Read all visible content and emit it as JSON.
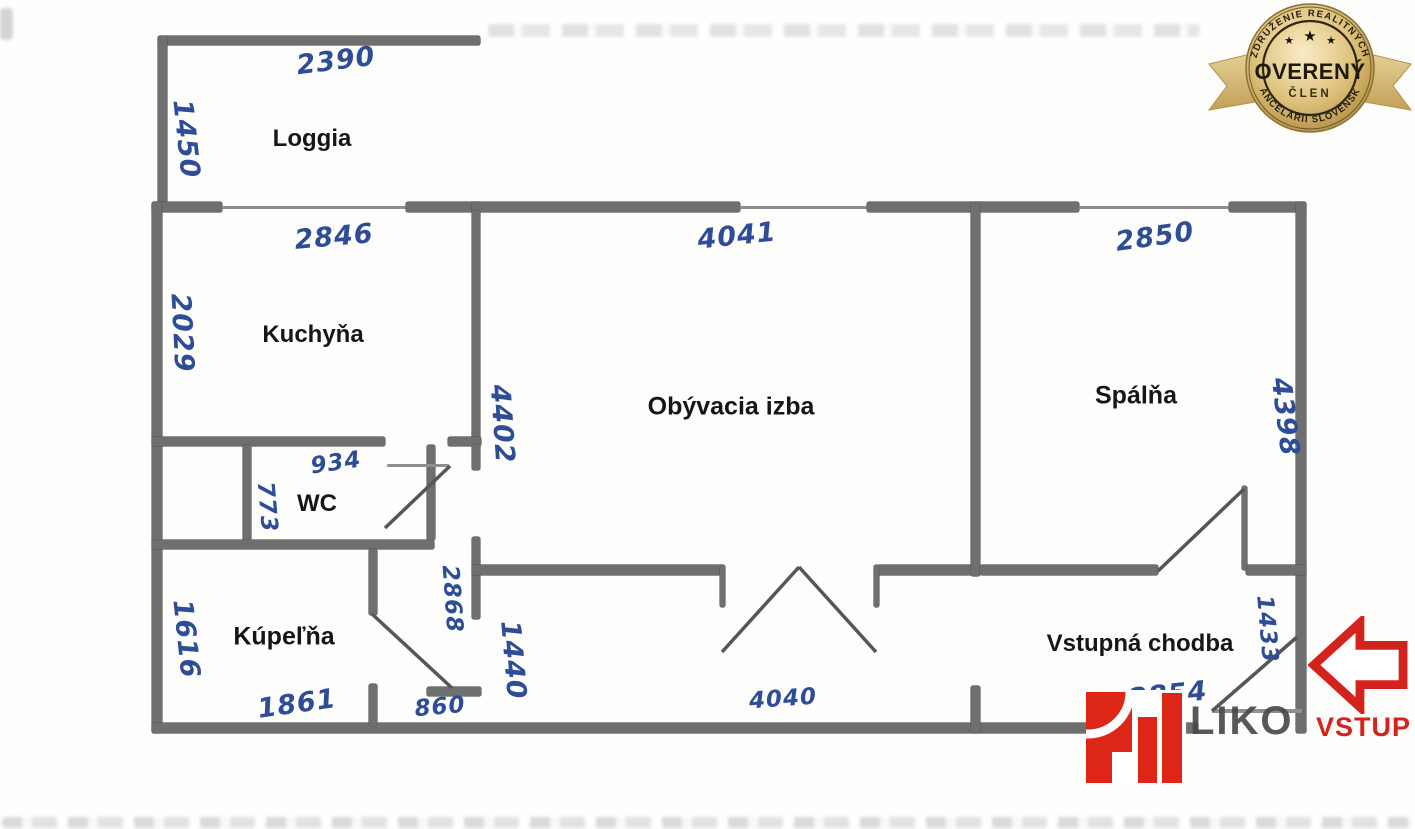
{
  "floorplan": {
    "rooms": {
      "loggia": {
        "label": "Loggia"
      },
      "kitchen": {
        "label": "Kuchyňa"
      },
      "wc": {
        "label": "WC"
      },
      "bathroom": {
        "label": "Kúpeľňa"
      },
      "living": {
        "label": "Obývacia izba"
      },
      "bedroom": {
        "label": "Spálňa"
      },
      "hall": {
        "label": "Vstupná chodba"
      }
    },
    "dimensions_mm": {
      "loggia_width": "2390",
      "loggia_depth": "1450",
      "kitchen_width": "2846",
      "kitchen_depth": "2029",
      "living_width": "4041",
      "living_depth": "4402",
      "bedroom_width": "2850",
      "bedroom_depth": "4398",
      "wc_width": "934",
      "wc_depth": "773",
      "corridor_depth": "2868",
      "corridor_width": "1440",
      "bathroom_depth": "1616",
      "bathroom_width": "1861",
      "nook_width": "860",
      "hall_bottom_width": "4040",
      "hall_width": "2854",
      "hall_depth": "1433"
    }
  },
  "badge": {
    "arc_top": "ZDRUŽENIE REALITNÝCH",
    "arc_bottom": "KANCELÁRIÍ SLOVENSKA",
    "title": "OVERENÝ",
    "subtitle": "ČLEN",
    "stars": {
      "left": "★",
      "center": "★",
      "right": "★"
    }
  },
  "entrance": {
    "label": "VSTUP"
  },
  "watermark": {
    "fragment": "LIKO"
  },
  "colors": {
    "ink_blue": "#2e4d96",
    "wall_gray": "#6f6f6f",
    "accent_red": "#d3231c",
    "badge_gold": "#d2b272"
  }
}
